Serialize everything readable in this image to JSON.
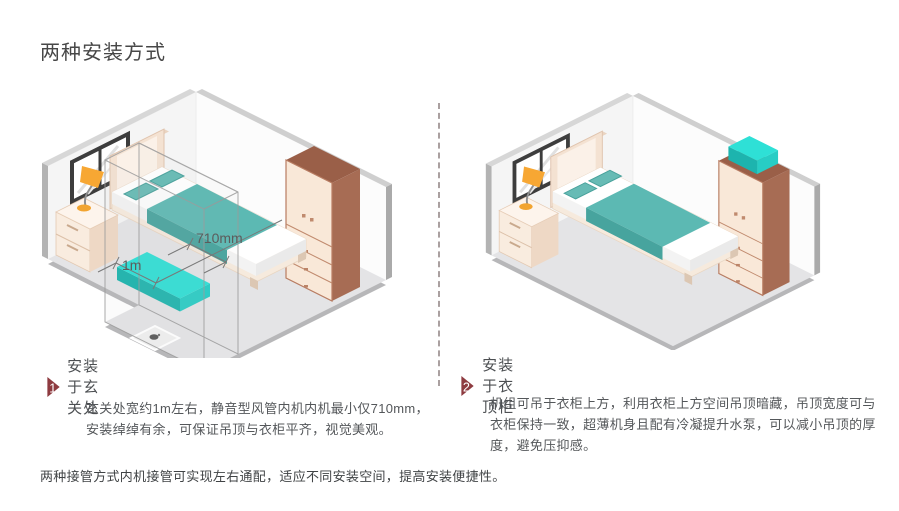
{
  "page": {
    "title": "两种安装方式",
    "footer": "两种接管方式内机接管可实现左右通配，适应不同安装空间，提高安装便捷性。"
  },
  "sections": [
    {
      "number": "1",
      "title": "安装于玄关处",
      "body": "玄关处宽约1m左右，静音型风管内机内机最小仅710mm，安装绰绰有余，可保证吊顶与衣柜平齐，视觉美观。"
    },
    {
      "number": "2",
      "title": "安装于衣顶柜",
      "body": "机组可吊于衣柜上方，利用衣柜上方空间吊顶暗藏，吊顶宽度可与衣柜保持一致，超薄机身且配有冷凝提升水泵，可以减小吊顶的厚度，避免压抑感。"
    }
  ],
  "diagram_left": {
    "label_width": "710mm",
    "label_depth": "1m"
  },
  "colors": {
    "badge": "#8e3b40",
    "ac_unit_top": "#2ee0d6",
    "blanket": "#5cb9b3",
    "wardrobe_side": "#a76c54",
    "divider_dash": "#aaa0a0",
    "floor": "#e4e4e6"
  }
}
